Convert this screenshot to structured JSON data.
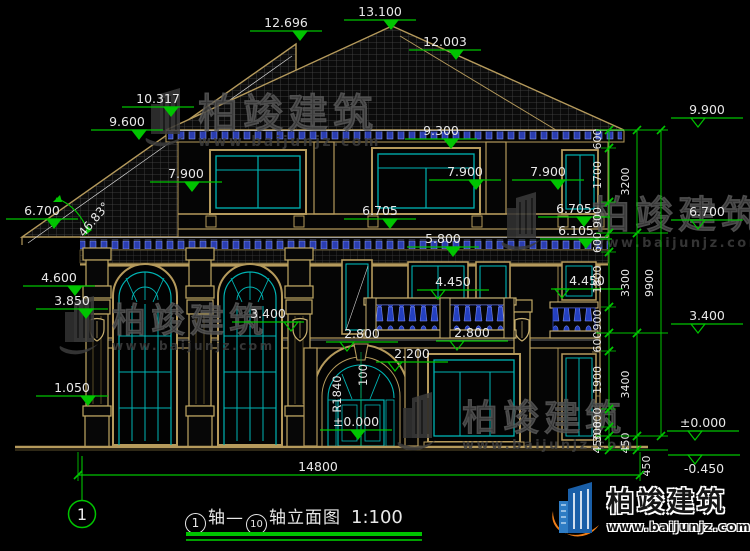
{
  "colors": {
    "bg": "#000000",
    "dim_green": "#00c400",
    "line_tan": "#b59a5c",
    "window_cyan": "#00b4b4",
    "baluster_blue": "#2f47c6",
    "text_white": "#e8e8e8",
    "watermark_gray": "#3e3e3e",
    "logo_orange": "#ee7d18",
    "logo_blue": "#1a5fa8"
  },
  "elevation_markers": [
    {
      "label": "12.696",
      "cx": 286,
      "y": 31,
      "tip": 300,
      "filled": 1
    },
    {
      "label": "13.100",
      "cx": 380,
      "y": 20,
      "tip": 391,
      "filled": 1
    },
    {
      "label": "12.003",
      "cx": 445,
      "y": 50,
      "tip": 456,
      "filled": 1
    },
    {
      "label": "10.317",
      "cx": 158,
      "y": 107,
      "tip": 171,
      "filled": 1
    },
    {
      "label": "9.600",
      "cx": 127,
      "y": 130,
      "tip": 139,
      "filled": 1
    },
    {
      "label": "9.300",
      "cx": 441,
      "y": 139,
      "tip": 451,
      "filled": 1
    },
    {
      "label": "7.900",
      "cx": 186,
      "y": 182,
      "tip": 192,
      "filled": 1
    },
    {
      "label": "7.900",
      "cx": 465,
      "y": 180,
      "tip": 476,
      "filled": 1
    },
    {
      "label": "7.900",
      "cx": 548,
      "y": 180,
      "tip": 558,
      "filled": 1
    },
    {
      "label": "9.900",
      "cx": 707,
      "y": 118,
      "tip": 698,
      "filled": 0
    },
    {
      "label": "6.700",
      "cx": 42,
      "y": 219,
      "tip": 54,
      "filled": 1
    },
    {
      "label": "6.705",
      "cx": 380,
      "y": 219,
      "tip": 390,
      "filled": 1
    },
    {
      "label": "6.705",
      "cx": 574,
      "y": 217,
      "tip": 584,
      "filled": 1
    },
    {
      "label": "6.105",
      "cx": 576,
      "y": 239,
      "tip": 586,
      "filled": 1
    },
    {
      "label": "6.700",
      "cx": 707,
      "y": 220,
      "tip": 698,
      "filled": 0
    },
    {
      "label": "5.800",
      "cx": 443,
      "y": 247,
      "tip": 453,
      "filled": 1
    },
    {
      "label": "4.600",
      "cx": 59,
      "y": 286,
      "tip": 75,
      "filled": 1
    },
    {
      "label": "3.850",
      "cx": 72,
      "y": 309,
      "tip": 86,
      "filled": 1
    },
    {
      "label": "4.450",
      "cx": 453,
      "y": 290,
      "tip": 438,
      "filled": 0
    },
    {
      "label": "4.450",
      "cx": 587,
      "y": 289,
      "tip": 562,
      "filled": 0
    },
    {
      "label": "3.400",
      "cx": 268,
      "y": 322,
      "tip": 291,
      "filled": 0
    },
    {
      "label": "3.400",
      "cx": 707,
      "y": 324,
      "tip": 698,
      "filled": 0
    },
    {
      "label": "2.800",
      "cx": 362,
      "y": 342,
      "tip": 347,
      "filled": 0
    },
    {
      "label": "2.800",
      "cx": 472,
      "y": 341,
      "tip": 457,
      "filled": 0
    },
    {
      "label": "2.200",
      "cx": 412,
      "y": 362,
      "tip": 395,
      "filled": 0
    },
    {
      "label": "1.050",
      "cx": 72,
      "y": 396,
      "tip": 88,
      "filled": 1
    },
    {
      "label": "±0.000",
      "cx": 356,
      "y": 430,
      "tip": 358,
      "filled": 1
    },
    {
      "label": "±0.000",
      "cx": 703,
      "y": 431,
      "tip": 695,
      "filled": 0
    },
    {
      "label": "-0.450",
      "cx": 704,
      "y": 455,
      "tip": 695,
      "filled": 0,
      "below": 1
    }
  ],
  "angle_annotation": {
    "label": "46.83°",
    "x": 97,
    "y": 222,
    "rot": -50
  },
  "arch_annotations": [
    {
      "label": "R1840",
      "x": 341,
      "y": 394,
      "rot": -90
    },
    {
      "label": "100",
      "x": 367,
      "y": 375,
      "rot": -90
    }
  ],
  "dimension_chains": [
    {
      "x": 609,
      "label_x": 601,
      "segs": [
        [
          "600",
          130,
          148
        ],
        [
          "1700",
          148,
          202
        ],
        [
          "900",
          202,
          233
        ],
        [
          "600",
          233,
          252
        ],
        [
          "1800",
          252,
          307
        ],
        [
          "900",
          307,
          333
        ],
        [
          "600",
          333,
          351
        ],
        [
          "1900",
          351,
          409
        ],
        [
          "600",
          409,
          427
        ],
        [
          "300",
          427,
          436
        ],
        [
          "450",
          436,
          450
        ]
      ]
    },
    {
      "x": 637,
      "label_x": 629,
      "segs": [
        [
          "3200",
          130,
          233
        ],
        [
          "3300",
          233,
          333
        ],
        [
          "3400",
          333,
          436
        ],
        [
          "450",
          436,
          450
        ]
      ]
    },
    {
      "x": 661,
      "label_x": 653,
      "segs": [
        [
          "9900",
          130,
          436
        ]
      ]
    }
  ],
  "extra_dimension_labels": [
    {
      "label": "450",
      "x": 650,
      "y": 466
    }
  ],
  "dim_connectors": {
    "major_y": [
      130,
      233,
      333,
      436,
      450
    ],
    "minor_y": [
      148,
      202,
      252,
      307,
      351,
      409,
      427
    ],
    "major_x": [
      596,
      668
    ],
    "minor_x": [
      601,
      616
    ]
  },
  "bottom_dimension": {
    "label": "14800",
    "x1": 78,
    "x2": 640,
    "y": 475,
    "tx": 318,
    "ty": 471
  },
  "axis_bubble": {
    "label": "1",
    "cx": 82,
    "cy": 514,
    "r": 13.5,
    "line_y1": 456,
    "line_y2": 500
  },
  "title_bar": {
    "full": "①轴—⑩轴立面图 1:100",
    "axis_start": "1",
    "text_mid": "轴—",
    "axis_end": "10",
    "text_suffix": "轴立面图",
    "scale": "1:100"
  },
  "watermarks": [
    {
      "brand": "柏竣建筑",
      "url": "www.baijunjz.com",
      "x": 198,
      "y": 127,
      "uy": 146,
      "fs": 40,
      "us": 14,
      "lx": 148,
      "ly": 88
    },
    {
      "brand": "柏竣建筑",
      "url": "www.baijunjz.com",
      "x": 592,
      "y": 228,
      "uy": 247,
      "fs": 38,
      "us": 13,
      "lx": 504,
      "ly": 192
    },
    {
      "brand": "柏竣建筑",
      "url": "www.baijunjz.com",
      "x": 112,
      "y": 332,
      "uy": 350,
      "fs": 34,
      "us": 12,
      "lx": 62,
      "ly": 296
    },
    {
      "brand": "柏竣建筑",
      "url": "www.baijunjz.com",
      "x": 462,
      "y": 430,
      "uy": 449,
      "fs": 36,
      "us": 13,
      "lx": 400,
      "ly": 392
    }
  ],
  "brand_logo": {
    "name": "柏竣建筑",
    "url": "www.baijunjz.com"
  }
}
